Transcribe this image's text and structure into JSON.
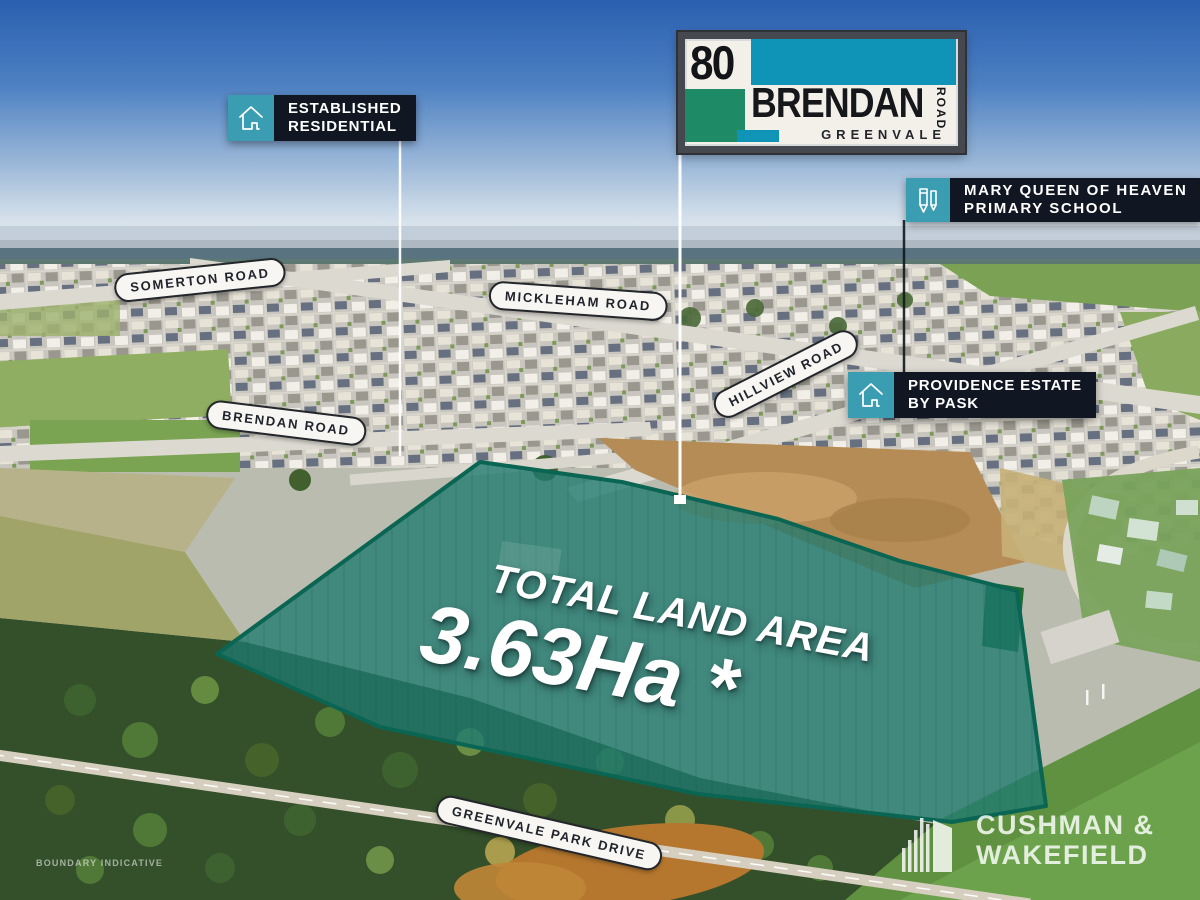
{
  "sign": {
    "number": "80",
    "street": "BRENDAN",
    "road_word": "ROAD",
    "suburb": "GREENVALE"
  },
  "callouts": {
    "established": {
      "line1": "ESTABLISHED",
      "line2": "RESIDENTIAL",
      "icon": "house-icon"
    },
    "school": {
      "line1": "MARY QUEEN OF HEAVEN",
      "line2": "PRIMARY SCHOOL",
      "icon": "pencil-icon"
    },
    "providence": {
      "line1": "PROVIDENCE ESTATE",
      "line2": "BY PASK",
      "icon": "house-icon"
    }
  },
  "roads": [
    {
      "name": "SOMERTON ROAD"
    },
    {
      "name": "MICKLEHAM ROAD"
    },
    {
      "name": "HILLVIEW ROAD"
    },
    {
      "name": "BRENDAN ROAD"
    },
    {
      "name": "GREENVALE PARK DRIVE"
    }
  ],
  "parcel": {
    "title": "TOTAL LAND AREA",
    "area": "3.63Ha *"
  },
  "logo": {
    "line1": "CUSHMAN &",
    "line2": "WAKEFIELD"
  },
  "disclaimer": "BOUNDARY INDICATIVE",
  "colors": {
    "sign_teal": "#0f93b6",
    "sign_green": "#1e8a66",
    "callout_icon_teal": "#3b9db2",
    "callout_bg": "#111722",
    "parcel_fill": "#1f7a70",
    "parcel_stroke": "#0b6553",
    "sky_top": "#2a5fb0"
  }
}
